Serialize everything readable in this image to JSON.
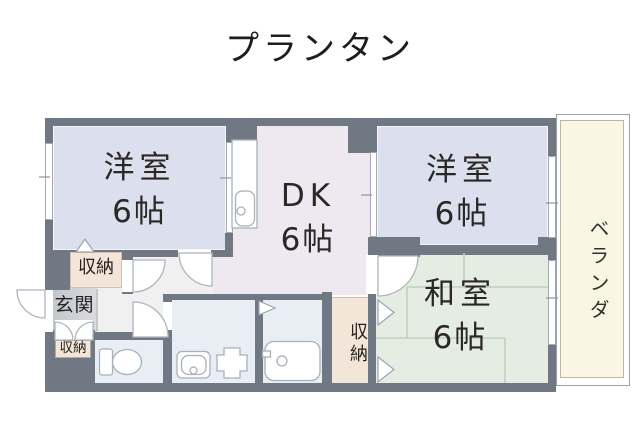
{
  "title": "プランタン",
  "rooms": {
    "western1": {
      "name": "洋室",
      "size": "6帖"
    },
    "western2": {
      "name": "洋室",
      "size": "6帖"
    },
    "dk": {
      "name": "DK",
      "size": "6帖"
    },
    "japanese": {
      "name": "和室",
      "size": "6帖"
    },
    "veranda": {
      "name": "ベランダ"
    },
    "entrance": {
      "name": "玄関"
    },
    "closet_west1": {
      "name": "収納"
    },
    "closet_entrance": {
      "name": "収納"
    },
    "closet_bath": {
      "name": "収納"
    }
  },
  "colors": {
    "wall": "#6f7883",
    "western_room": "#dcdfee",
    "dk": "#eee8f1",
    "japanese_room": "#e5ede3",
    "wet_area": "#e8eef4",
    "hallway": "#f0f0f1",
    "entrance_floor": "#c8ccd2",
    "closet": "#f3e6d8",
    "veranda": "#faf6e3",
    "tatami_line": "#bed1bd"
  }
}
